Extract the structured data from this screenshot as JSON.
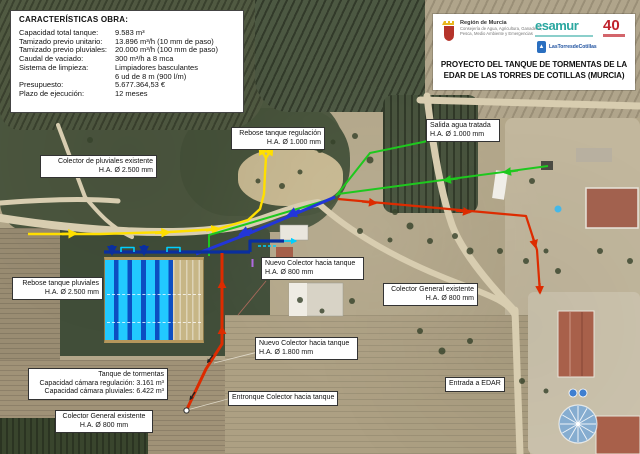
{
  "meta": {
    "width": 640,
    "height": 454,
    "description": "Aerial project plan overlay"
  },
  "colors": {
    "pipe_yellow": "#ffdf00",
    "pipe_green": "#1ec81e",
    "pipe_red": "#dd2b00",
    "pipe_blue": "#2236d9",
    "pipe_cyan": "#00cfff",
    "pipe_navy": "#0a2f9e",
    "accent_violet": "#b06ae0",
    "esamur_teal": "#2ba7a0",
    "logo40_red": "#c0232c",
    "torres_blue": "#2a6fc0",
    "murcia_red": "#b5332a"
  },
  "specs_panel": {
    "title": "CARACTERÍSTICAS OBRA:",
    "rows": [
      {
        "label": "Capacidad total tanque:",
        "value": "9.583 m³"
      },
      {
        "label": "Tamizado previo unitario:",
        "value": "13.896 m³/h (10 mm de paso)"
      },
      {
        "label": "Tamizado previo pluviales:",
        "value": "20.000 m³/h (100 mm de paso)"
      },
      {
        "label": "Caudal de vaciado:",
        "value": "300 m³/h a 8 mca"
      },
      {
        "label": "Sistema de limpieza:",
        "value": "Limpiadores basculantes"
      },
      {
        "label": "",
        "value": "6 ud de 8 m (900 l/m)"
      },
      {
        "label": "Presupuesto:",
        "value": "5.677.364,53 €"
      },
      {
        "label": "Plazo de ejecución:",
        "value": "12 meses"
      }
    ]
  },
  "title_block": {
    "line1": "PROYECTO DEL TANQUE DE TORMENTAS DE LA",
    "line2": "EDAR DE LAS TORRES DE COTILLAS (MURCIA)",
    "murcia": {
      "name": "Región de Murcia",
      "dept1": "Consejería de Agua, Agricultura, Ganadería,",
      "dept2": "Pesca, Medio Ambiente y Emergencias"
    },
    "esamur": "esamur",
    "anniversary": "40",
    "torres": "LasTorresdeCotillas"
  },
  "callouts": {
    "rebose_regulacion": {
      "line1": "Rebose tanque regulación",
      "line2": "H.A. Ø 1.000 mm"
    },
    "salida_agua": {
      "line1": "Salida agua tratada",
      "line2": "H.A. Ø 1.000 mm"
    },
    "colector_pluviales": {
      "line1": "Colector de pluviales existente",
      "line2": "H.A. Ø 2.500 mm"
    },
    "rebose_pluviales": {
      "line1": "Rebose tanque pluviales",
      "line2": "H.A. Ø 2.500 mm"
    },
    "nuevo_colector_800": {
      "line1": "Nuevo Colector hacia tanque",
      "line2": "H.A. Ø 800 mm"
    },
    "colector_general_este": {
      "line1": "Colector General existente",
      "line2": "H.A. Ø 800 mm"
    },
    "nuevo_colector_1800": {
      "line1": "Nuevo Colector hacia tanque",
      "line2": "H.A. Ø 1.800 mm"
    },
    "entronque": {
      "line1": "Entronque Colector hacia tanque"
    },
    "tanque_tormentas": {
      "line1": "Tanque de tormentas",
      "line2": "Capacidad cámara regulación: 3.161 m³",
      "line3": "Capacidad cámara pluviales: 6.422 m³"
    },
    "colector_general_sur": {
      "line1": "Colector General existente",
      "line2": "H.A. Ø 800 mm"
    },
    "entrada_edar": {
      "line1": "Entrada a EDAR"
    }
  }
}
